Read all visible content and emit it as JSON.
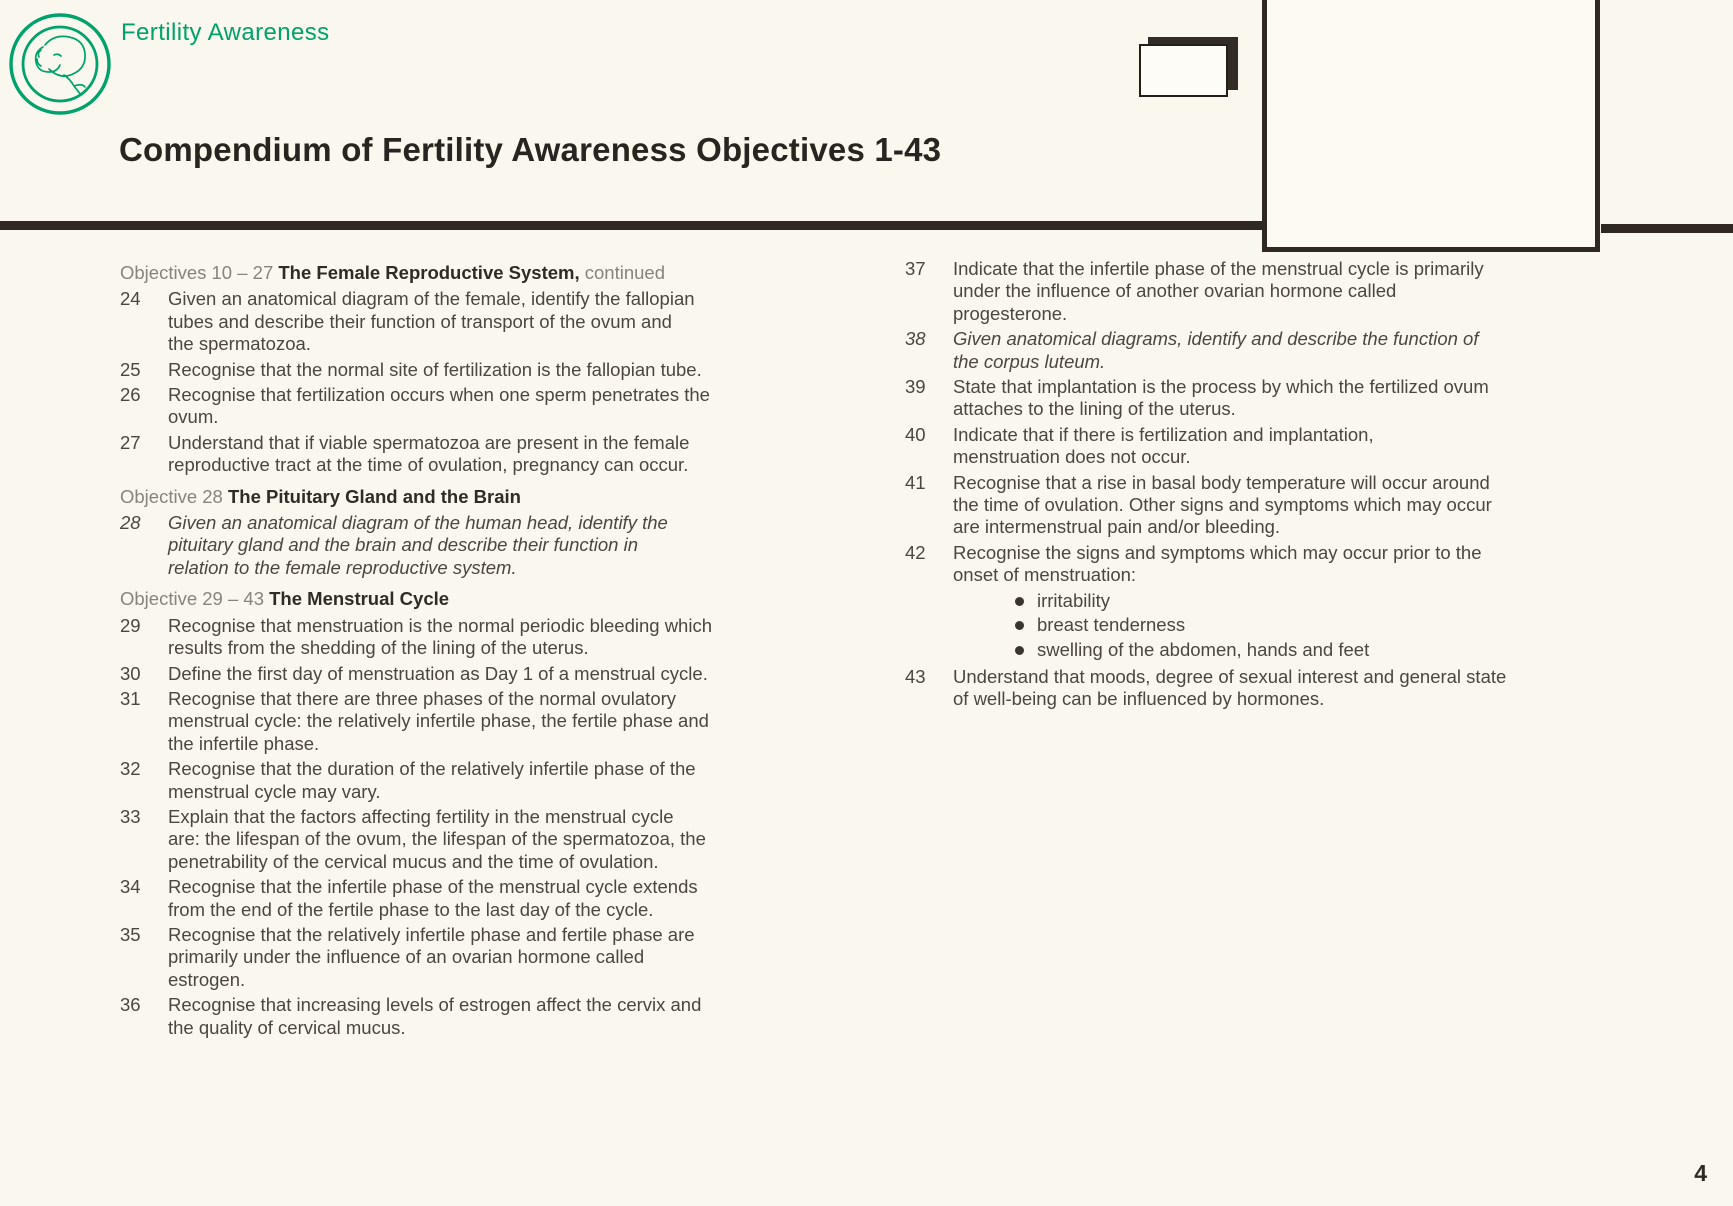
{
  "header": {
    "brand": "Fertility Awareness",
    "title": "Compendium of Fertility Awareness Objectives 1-43"
  },
  "footer": {
    "page_number": "4"
  },
  "icons": {
    "logo": "fetus-in-double-circle-logo",
    "corner_mark": "stacked-document-icon"
  },
  "colors": {
    "accent_green": "#00a26b",
    "bar": "#2f2922",
    "body_text": "#4b473f",
    "muted_heading": "#87847b",
    "background": "#f9f7ee"
  },
  "columns": {
    "left": [
      {
        "type": "heading",
        "prefix": "Objectives 10 – 27 ",
        "strong": "The Female Reproductive System,",
        "suffix": " continued"
      },
      {
        "type": "item",
        "num": "24",
        "text": "Given an anatomical diagram of the female, identify the fallopian\ntubes and describe their function of transport of the ovum and\nthe spermatozoa."
      },
      {
        "type": "item",
        "num": "25",
        "text": "Recognise that the normal site of fertilization is the fallopian tube."
      },
      {
        "type": "item",
        "num": "26",
        "text": "Recognise that fertilization occurs when one sperm penetrates the\novum."
      },
      {
        "type": "item",
        "num": "27",
        "text": "Understand that if viable spermatozoa are present in the female\nreproductive tract at the time of ovulation, pregnancy can occur."
      },
      {
        "type": "heading",
        "prefix": "Objective 28 ",
        "strong": "The Pituitary Gland and the Brain",
        "suffix": ""
      },
      {
        "type": "item",
        "num": "28",
        "italic": true,
        "text": "Given an anatomical diagram of the human head, identify the\npituitary gland and the brain and describe their function in\nrelation to the female reproductive system."
      },
      {
        "type": "heading",
        "prefix": "Objective 29 – 43 ",
        "strong": "The Menstrual Cycle",
        "suffix": ""
      },
      {
        "type": "item",
        "num": "29",
        "text": "Recognise that menstruation is the normal periodic bleeding which\nresults from the shedding of the lining of the uterus."
      },
      {
        "type": "item",
        "num": "30",
        "text": "Define the first day of menstruation as Day 1 of a menstrual cycle."
      },
      {
        "type": "item",
        "num": "31",
        "text": "Recognise that there are three phases of the normal ovulatory\nmenstrual cycle: the relatively infertile phase, the fertile phase and\nthe infertile phase."
      },
      {
        "type": "item",
        "num": "32",
        "text": "Recognise that the duration of the relatively infertile phase of the\nmenstrual cycle may vary."
      },
      {
        "type": "item",
        "num": "33",
        "text": "Explain that the factors affecting fertility in the menstrual cycle\nare: the lifespan of the ovum, the lifespan of the spermatozoa, the\npenetrability of the cervical mucus and the time of ovulation."
      },
      {
        "type": "item",
        "num": "34",
        "text": "Recognise that the infertile phase of the menstrual cycle extends\nfrom the end of the fertile phase to the last day of the cycle."
      },
      {
        "type": "item",
        "num": "35",
        "text": "Recognise that the relatively infertile phase and fertile phase are\nprimarily under the influence of an ovarian hormone called\nestrogen."
      },
      {
        "type": "item",
        "num": "36",
        "text": "Recognise that increasing levels of estrogen affect the cervix and\nthe quality of cervical mucus."
      }
    ],
    "right": [
      {
        "type": "item",
        "num": "37",
        "text": "Indicate that the infertile phase of the menstrual cycle is primarily\nunder the influence of another ovarian hormone called\nprogesterone."
      },
      {
        "type": "item",
        "num": "38",
        "italic": true,
        "text": "Given anatomical diagrams, identify and describe the function of\nthe corpus luteum."
      },
      {
        "type": "item",
        "num": "39",
        "text": "State that implantation is the process by which the fertilized ovum\nattaches to the lining of the uterus."
      },
      {
        "type": "item",
        "num": "40",
        "text": "Indicate that if there is fertilization and implantation,\nmenstruation does not occur."
      },
      {
        "type": "item",
        "num": "41",
        "text": "Recognise that a rise in basal body temperature will occur around\nthe time of ovulation. Other signs and symptoms which may occur\nare intermenstrual pain and/or bleeding."
      },
      {
        "type": "item",
        "num": "42",
        "text": "Recognise the signs and symptoms which may occur prior to the\nonset of menstruation:",
        "bullets": [
          "irritability",
          "breast tenderness",
          "swelling of the abdomen, hands and feet"
        ]
      },
      {
        "type": "item",
        "num": "43",
        "text": "Understand that moods, degree of sexual interest and general state\nof well-being can be influenced by hormones."
      }
    ]
  }
}
